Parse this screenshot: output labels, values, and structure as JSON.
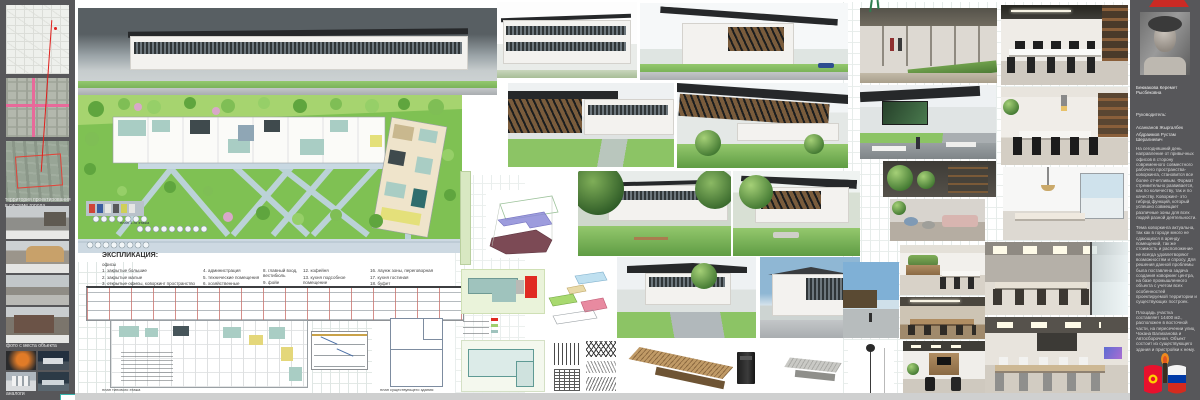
{
  "left_panel": {
    "territory_caption": "территория проектирования в системе города",
    "site_photos_caption": "фото с места объекта",
    "analogs_caption": "аналоги"
  },
  "plans": {
    "first_floor_caption": "план 1-го этажа",
    "typical_floor_caption": "план типового этажа",
    "existing_building_caption": "план существующего здания"
  },
  "explication": {
    "title": "ЭКСПЛИКАЦИЯ:",
    "group": "офисы",
    "col1": [
      "1. закрытые большие",
      "2. закрытые малые",
      "3. открытые офисы, коворкинг пространство"
    ],
    "col2": [
      "4. администрация",
      "5. технические помещения",
      "6. хозяйственные помещения",
      "7. сан узел для персонала"
    ],
    "col3": [
      "8. главный вход, вестибюль",
      "9. фойе",
      "10. атриум",
      "11. сан узел м,ж."
    ],
    "col4": [
      "12. кофейня",
      "13. кухня подсобное помещение",
      "14. терраса",
      "15. сан узел для персонала"
    ],
    "col5": [
      "16. лаунж зоны, переговорная",
      "17. кухня гостиная",
      "18. буфет",
      "19. кухня буфета"
    ]
  },
  "info_panel": {
    "student_name": "Бекмакова Керемет Рысбековна",
    "supervisor_label": "Руководитель:",
    "supervisor_1": "Асанканов Жыргалбек",
    "supervisor_2": "Абдраимов Рустам Шералиевич",
    "paragraph_1": "На сегодняшний день направление от привычных офисов в сторону современного совместного рабочего пространства-коворкинга, становится все более отчетливым. Формат стремительно развивается, как по количеству, так и по качеству. Коворкинг- это гибрид функций, который успешно совмещает различные зоны для всех людей разной деятельности.",
    "paragraph_2": "Тема коворкинга актуальна, так как в городе много не сдающихся в аренду помещений, так же стоимость и расположение не всегда удовлетворяют возможностям и спросу. Для решения данной проблемы была поставлена задача создания коворкинг центра, на базе промышленного объекта с учетом всех особенностей проектируемой территории и существующих построек.",
    "paragraph_3": "Площадь участка составляет 14400 м2., расположен в восточной части, на пересечении улиц Чокана Валиханова и Автосборочная. Объект состоит из существующего здания и пристройки к нему."
  },
  "colors": {
    "panel_gray": "#57575a",
    "lawn_green": "#7fc153",
    "path_blue": "#bfd3df",
    "room_teal": "#a9cdc4",
    "accent_red": "#d03029",
    "kyrgyz_flag_red": "#e8112d",
    "russia_flag_blue": "#0039a6"
  }
}
